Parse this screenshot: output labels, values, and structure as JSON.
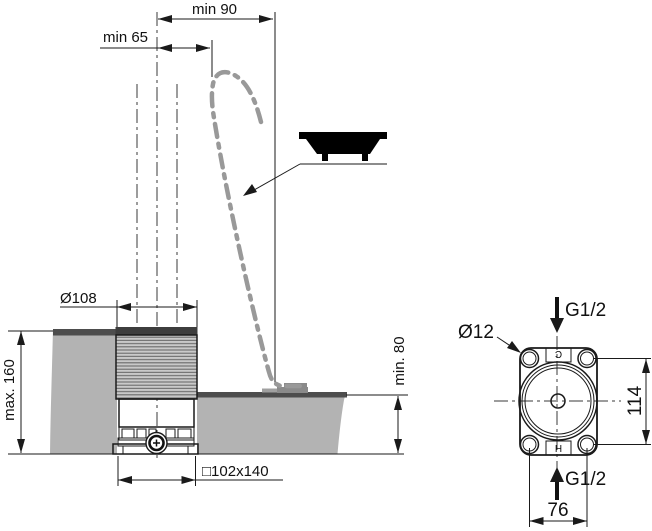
{
  "drawing": {
    "type": "installation dimension drawing, bath pillar spout",
    "side_view": {
      "min90": "min 90",
      "min65": "min 65",
      "dia108": "Ø108",
      "max160": "max. 160",
      "min80": "min. 80",
      "base_size": "□102x140"
    },
    "top_view": {
      "dia12": "Ø12",
      "inlet_top": "G1/2",
      "inlet_bottom": "G1/2",
      "hole_spacing_vertical": "114",
      "hole_spacing_horizontal": "76",
      "port_top_letter": "C",
      "port_bottom_letter": "H"
    },
    "colors": {
      "line": "#1a1a1a",
      "deck_fill": "#b3b3b3",
      "deck_top_edge": "#4d4d4d",
      "spout_phantom": "#999999",
      "thread_fill": "#c9c9c9"
    }
  }
}
